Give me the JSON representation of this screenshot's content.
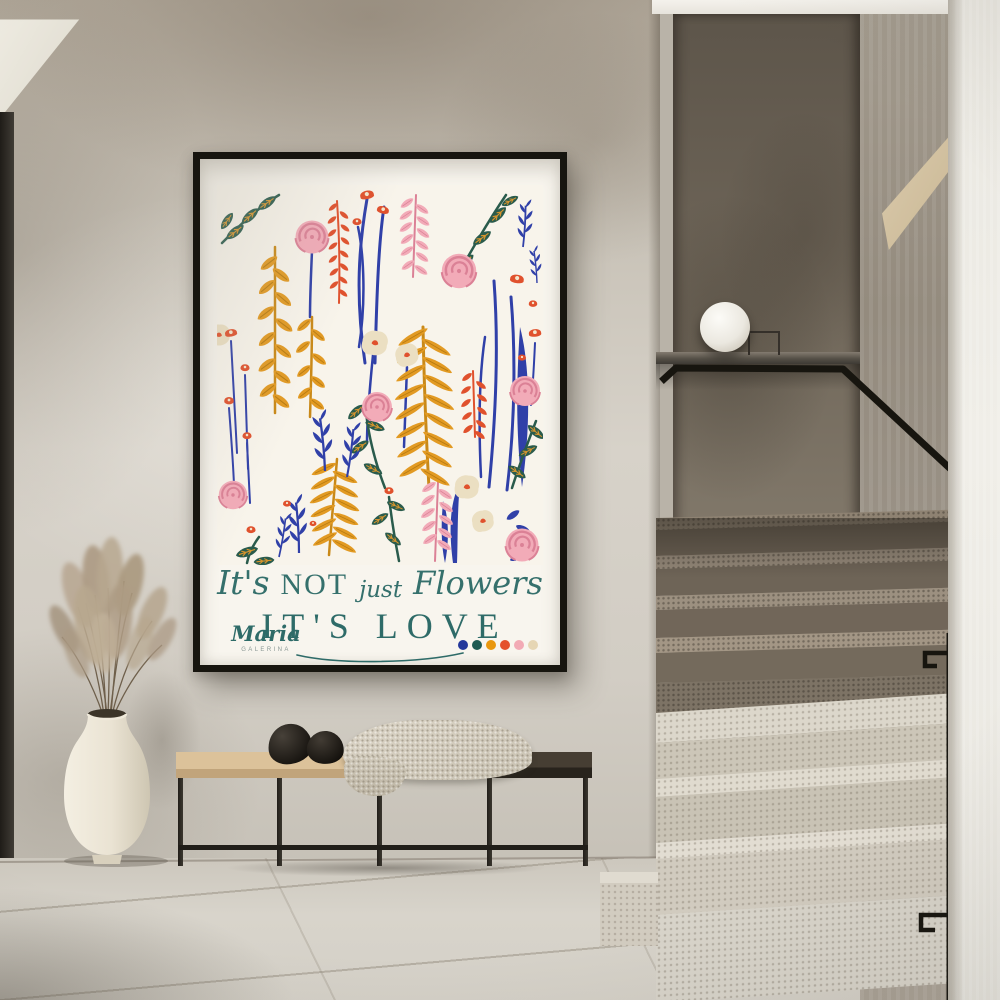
{
  "poster": {
    "line1": {
      "word1": "It's",
      "word2": "NOT",
      "word3": "just",
      "word4": "Flowers"
    },
    "line2": "IT'S LOVE",
    "signature": "Maria",
    "signature_subtitle": "GALERINA",
    "palette_dots": [
      "#24389b",
      "#1d5a52",
      "#e9970e",
      "#e4512c",
      "#f2aab5",
      "#e6d6b4"
    ],
    "art_palette": {
      "background": "#f8f4eb",
      "navy": "#3040a8",
      "green": "#2a5b4c",
      "mustard": "#e29a23",
      "red_orange": "#e0512d",
      "pink": "#f2abb8",
      "deep_pink": "#db8196",
      "cream": "#ebdfc2",
      "text_teal": "#2e6b68"
    }
  },
  "scene": {
    "colors": {
      "wall": "#cdc7bc",
      "floor": "#d6d2c9",
      "frame": "#17150f",
      "stair_back_wall": "#6f6659",
      "stair_steps_light": "#d8d3c7",
      "stair_steps_dark": "#746a5c",
      "right_wall": "#ecebe4",
      "bench_seat_light": "#d7bb92",
      "bench_seat_dark": "#3b332a",
      "blanket": "#d0c9bb",
      "vase": "#ece5d6",
      "pampas": "#b2a08a",
      "lamp": "#f6f4ee",
      "handrail": "#1b1916"
    }
  }
}
